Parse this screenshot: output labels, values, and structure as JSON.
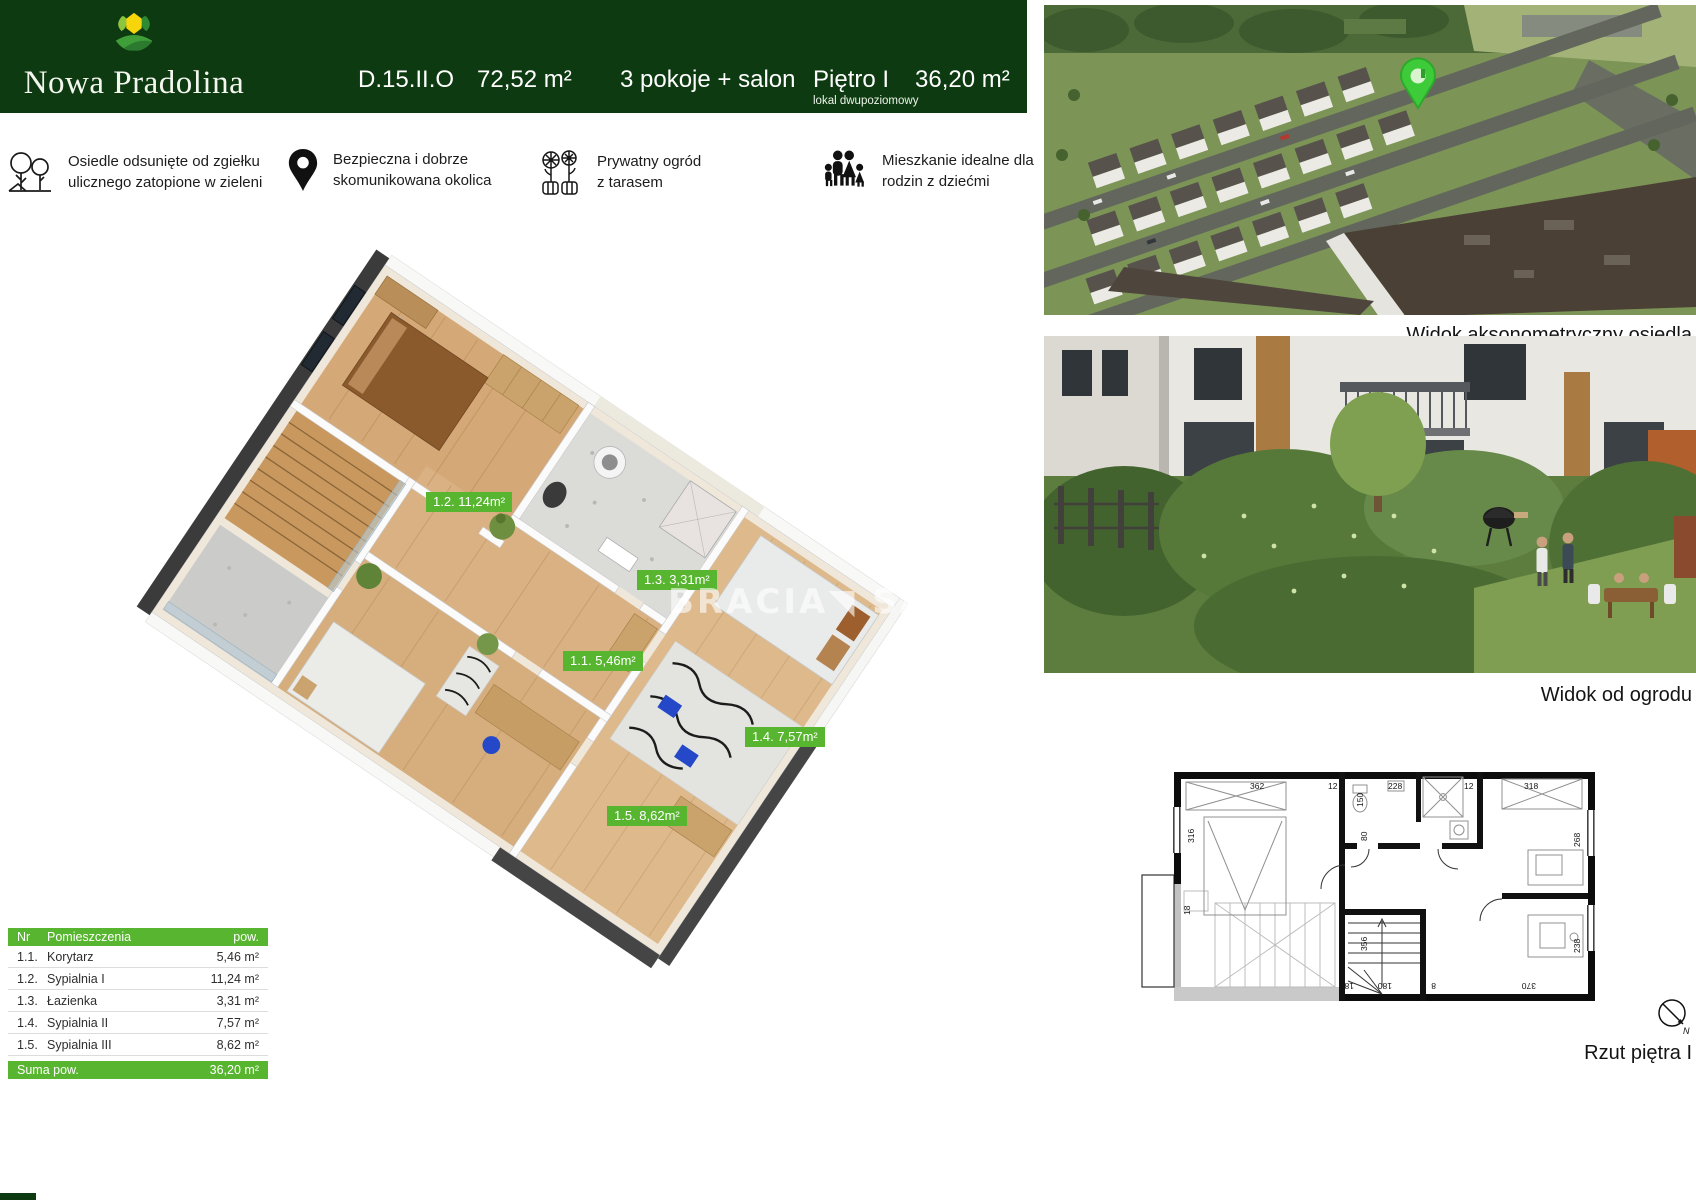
{
  "header": {
    "brand": "Nowa Pradolina",
    "unit_code": "D.15.II.O",
    "total_area": "72,52 m²",
    "rooms": "3 pokoje + salon",
    "floor": "Piętro I",
    "floor_note": "lokal dwupoziomowy",
    "floor_area": "36,20 m²"
  },
  "features": [
    {
      "icon": "trees-icon",
      "line1": "Osiedle odsunięte od zgiełku",
      "line2": "ulicznego zatopione w zieleni"
    },
    {
      "icon": "map-pin-icon",
      "line1": "Bezpieczna i dobrze",
      "line2": "skomunikowana okolica"
    },
    {
      "icon": "garden-flowers-icon",
      "line1": "Prywatny ogród",
      "line2": "z tarasem"
    },
    {
      "icon": "family-icon",
      "line1": "Mieszkanie idealne dla",
      "line2": "rodzin z dziećmi"
    }
  ],
  "plan3d": {
    "watermark": "BRACIA◥ SAD",
    "labels": [
      "1.1. 5,46m²",
      "1.2. 11,24m²",
      "1.3. 3,31m²",
      "1.4. 7,57m²",
      "1.5. 8,62m²"
    ]
  },
  "table": {
    "header": {
      "nr": "Nr",
      "name": "Pomieszczenia",
      "area": "pow."
    },
    "rows": [
      {
        "nr": "1.1.",
        "name": "Korytarz",
        "area": "5,46 m²"
      },
      {
        "nr": "1.2.",
        "name": "Sypialnia I",
        "area": "11,24 m²"
      },
      {
        "nr": "1.3.",
        "name": "Łazienka",
        "area": "3,31 m²"
      },
      {
        "nr": "1.4.",
        "name": "Sypialnia II",
        "area": "7,57 m²"
      },
      {
        "nr": "1.5.",
        "name": "Sypialnia III",
        "area": "8,62 m²"
      }
    ],
    "total": {
      "label": "Suma pow.",
      "area": "36,20 m²"
    }
  },
  "captions": {
    "aerial": "Widok aksonometryczny osiedla",
    "garden": "Widok od ogrodu",
    "plan": "Rzut piętra I"
  },
  "plan2d": {
    "dims": [
      "362",
      "12",
      "150",
      "228",
      "12",
      "318",
      "316",
      "268",
      "18",
      "80",
      "356",
      "18",
      "180",
      "8",
      "370",
      "238"
    ],
    "compass": "N"
  },
  "colors": {
    "brand_green": "#0d3a10",
    "accent_green": "#57b52f",
    "pin_green": "#3ecb39"
  }
}
